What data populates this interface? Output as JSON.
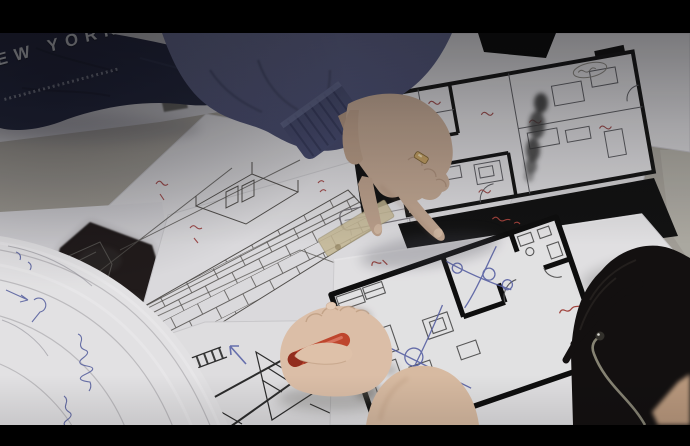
{
  "scene": {
    "type": "photograph",
    "description": "Two people at a table reviewing hand-drawn architectural floor plans and sketches; one hand points at a plan, another hand holds a capped red marker; the back of a head with glasses is in the lower right.",
    "letterbox_color": "#000000",
    "table_color": "#a39f97"
  },
  "sweatshirt": {
    "text": "NEW YORK",
    "visible_text": "W YORK",
    "fabric_color": "#262a40",
    "text_color": "#d5d7db"
  },
  "sleeve": {
    "color": "#5a5f83",
    "cuff_color": "#494e72"
  },
  "pointing_hand": {
    "skin_color": "#c6ab96",
    "ring_color": "#c8a466"
  },
  "drawing_hand": {
    "skin_color": "#e6c8af",
    "pen_color": "#c8492f",
    "pen_cap_color": "#992f1f",
    "pen_description": "capped red marker"
  },
  "head": {
    "hair_color": "#131010",
    "glasses_color": "#93907f",
    "skin_color": "#c2a083"
  },
  "papers": {
    "sheet_colors": [
      "#dbdadd",
      "#e5e4e7",
      "#eeedef"
    ],
    "tape_color": "#cdbf9a"
  },
  "floor_plan_upper": {
    "wall_color": "#171717",
    "line_color": "#606065",
    "mat_color": "#121212",
    "annotation_color": "#9f4f4f",
    "annotations": "small red handwritten room labels (Korean, illegible)",
    "smudge": "dark vertical eraser smudge across plan"
  },
  "floor_plan_lower": {
    "wall_color": "#0e0e0e",
    "line_color": "#5b5b5b",
    "pen_sketch_color": "#5b64aa",
    "annotation_color": "#a8453e",
    "annotations": "red circled marks and notes, blue crossing construction lines (illegible)"
  },
  "sketches": {
    "brick_perspective": {
      "line_color": "#55524f",
      "annotation_color": "#a85050"
    },
    "street_sketch": {
      "line_color": "#2e2e2e"
    },
    "charcoal_color": "#201e1c",
    "blue_arrow_color": "#6a73b5",
    "curled_pages_notes_color": "#5f68a8",
    "curled_pages_notes": "blue handwritten notes along curled page edges (Korean, illegible)"
  }
}
